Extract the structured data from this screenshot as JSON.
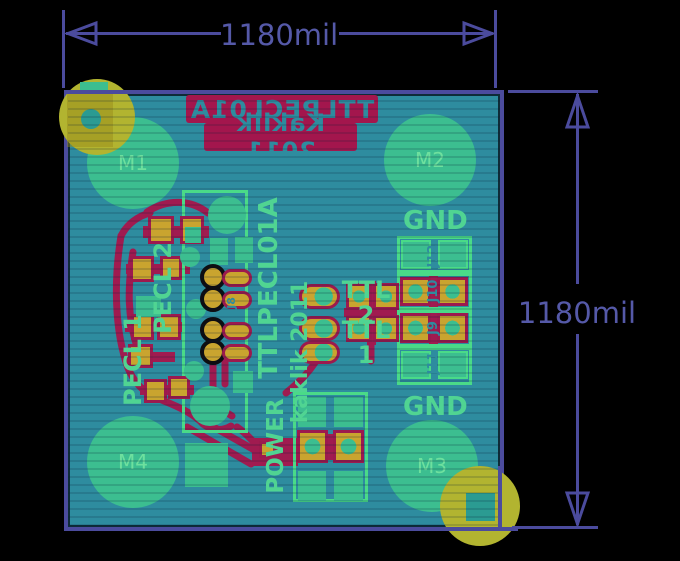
{
  "title": "PCB board render — TTLPECL01A",
  "dimension": {
    "top_label": "1180mil",
    "right_label": "1180mil"
  },
  "silkscreen_bottom": {
    "line1": "TTLPECL01A",
    "line2": "Kaklik 2011"
  },
  "mounting_holes": {
    "m1": "M1",
    "m2": "M2",
    "m3": "M3",
    "m4": "M4"
  },
  "labels": {
    "gnd_top": "GND",
    "gnd_bottom": "GND",
    "ttl2": "TTL 2",
    "ttl1": "TTL 1",
    "pecl2": "PECL 2",
    "pecl1": "PECL 1",
    "title_vertical": "TTLPECL01A",
    "author_vertical": "kaklik 2011",
    "power": "POWER",
    "j12": "J12",
    "j10": "J10",
    "j9": "J9",
    "j11": "J11",
    "j8": "J8"
  },
  "colors": {
    "background": "#000000",
    "board_teal": "#2e8c9f",
    "copper_green": "#3cbe90",
    "silk_green": "#50d492",
    "bottom_copper_red": "#a01b50",
    "silk_red": "#a3164d",
    "pad_yellow": "#c9a42f",
    "drill_yellow": "#b2b430",
    "dimension_purple": "#4b4b9d"
  }
}
